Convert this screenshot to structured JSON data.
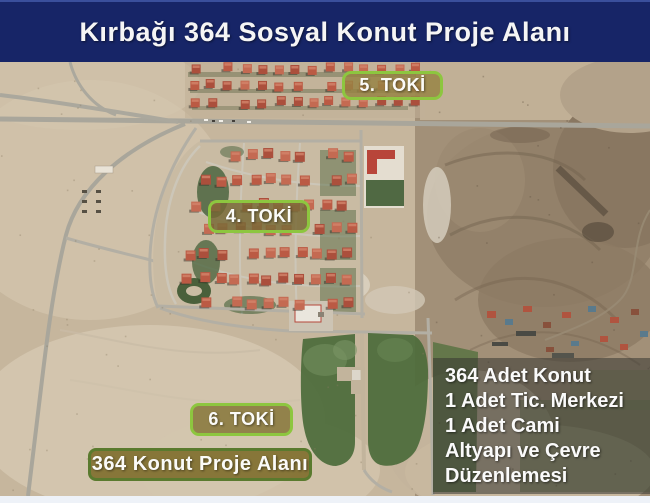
{
  "header": {
    "title": "Kırbağı 364 Sosyal Konut Proje Alanı",
    "bg_color": "#172567",
    "text_color": "#f5f5f5"
  },
  "map": {
    "type": "satellite-aerial-photo",
    "accent_border_color": "#8dc63f",
    "project_area_fill": "#4c6c3b",
    "labels": [
      {
        "id": "toki-5",
        "text": "5. TOKİ"
      },
      {
        "id": "toki-4",
        "text": "4. TOKİ"
      },
      {
        "id": "toki-6",
        "text": "6. TOKİ"
      },
      {
        "id": "project-area",
        "text": "364 Konut Proje Alanı"
      }
    ]
  },
  "info_box": {
    "lines": [
      "364 Adet Konut",
      "1 Adet Tic. Merkezi",
      "1 Adet Cami",
      "Altyapı ve Çevre Düzenlemesi"
    ]
  }
}
